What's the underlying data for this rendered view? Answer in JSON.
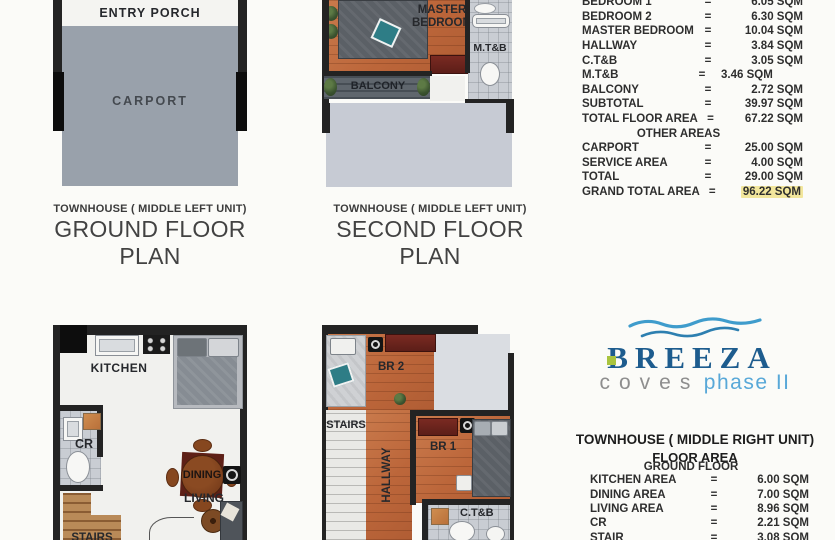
{
  "plan_ground_left": {
    "caption_small": "TOWNHOUSE ( MIDDLE LEFT UNIT)",
    "caption_large": "GROUND FLOOR PLAN",
    "labels": {
      "entry_porch": "ENTRY PORCH",
      "carport": "CARPORT"
    }
  },
  "plan_second_left": {
    "caption_small": "TOWNHOUSE ( MIDDLE LEFT UNIT)",
    "caption_large": "SECOND FLOOR PLAN",
    "labels": {
      "master_bedroom": "MASTER BEDROOM",
      "mtb": "M.T&B",
      "balcony": "BALCONY"
    }
  },
  "plan_ground_right": {
    "labels": {
      "kitchen": "KITCHEN",
      "cr": "CR",
      "dining": "DINING",
      "living": "LIVING",
      "stairs": "STAIRS"
    }
  },
  "plan_second_right": {
    "labels": {
      "br2": "BR 2",
      "stairs": "STAIRS",
      "hallway": "HALLWAY",
      "br1": "BR 1",
      "ctb": "C.T&B"
    }
  },
  "second_floor_table": {
    "equals": "=",
    "rows": [
      {
        "label": "BEDROOM 1",
        "value": "6.05 SQM"
      },
      {
        "label": "BEDROOM 2",
        "value": "6.30 SQM"
      },
      {
        "label": "MASTER BEDROOM",
        "value": "10.04 SQM"
      },
      {
        "label": "HALLWAY",
        "value": "3.84 SQM"
      },
      {
        "label": "C.T&B",
        "value": "3.05 SQM"
      },
      {
        "label": "M.T&B",
        "value": "3.46 SQM"
      },
      {
        "label": "BALCONY",
        "value": "2.72 SQM"
      },
      {
        "label": "SUBTOTAL",
        "value": "39.97 SQM"
      },
      {
        "label": "TOTAL FLOOR AREA",
        "value": "67.22 SQM"
      }
    ],
    "other_areas_title": "OTHER AREAS",
    "other_rows": [
      {
        "label": "CARPORT",
        "value": "25.00 SQM"
      },
      {
        "label": "SERVICE AREA",
        "value": "4.00 SQM"
      },
      {
        "label": "TOTAL",
        "value": "29.00 SQM"
      },
      {
        "label": "GRAND TOTAL AREA",
        "value": "96.22 SQM"
      }
    ],
    "grand_total_highlight": "#f2e69c"
  },
  "brand": {
    "name": "BREEZA",
    "tagline_word": "coves",
    "tagline_phase": "phase II",
    "name_color": "#1d5c8e",
    "tagline_word_color": "#8e8e8e",
    "tagline_phase_color": "#58a8d8",
    "accent_green": "#a9c43e",
    "wave_color": "#3f9ccc"
  },
  "right_unit": {
    "title": "TOWNHOUSE ( MIDDLE RIGHT UNIT)",
    "subtitle": "FLOOR AREA",
    "section": "GROUND FLOOR",
    "equals": "=",
    "rows": [
      {
        "label": "KITCHEN AREA",
        "value": "6.00 SQM"
      },
      {
        "label": "DINING AREA",
        "value": "7.00 SQM"
      },
      {
        "label": "LIVING AREA",
        "value": "8.96 SQM"
      },
      {
        "label": "CR",
        "value": "2.21 SQM"
      },
      {
        "label": "STAIR",
        "value": "3.08 SQM"
      }
    ]
  }
}
